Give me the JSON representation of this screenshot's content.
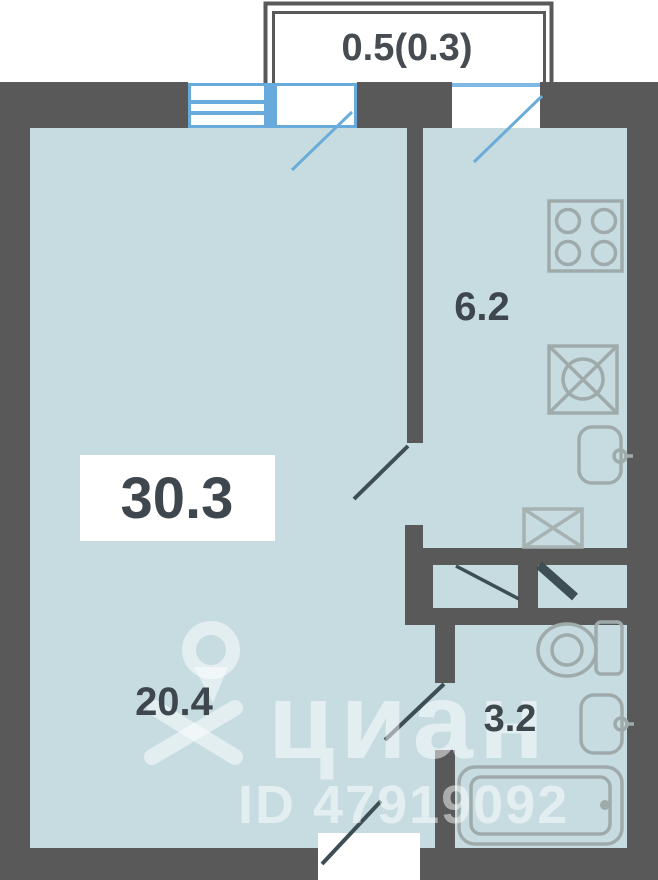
{
  "plan": {
    "balcony_label": "0.5(0.3)",
    "rooms": [
      {
        "id": "total-area",
        "label": "30.3"
      },
      {
        "id": "living-room",
        "label": "20.4"
      },
      {
        "id": "kitchen",
        "label": "6.2"
      },
      {
        "id": "bathroom",
        "label": "3.2"
      }
    ],
    "fixtures": [
      "stove",
      "kitchen-sink",
      "kitchen-washbasin",
      "wardrobe",
      "toilet",
      "washbasin",
      "bathtub"
    ],
    "colors": {
      "wall": "#595959",
      "floor": "#c6dce1",
      "window_blue": "#67aadb",
      "door_line": "#3e4e55",
      "fixture_stroke": "#9fabab",
      "label_text": "#3f474e"
    }
  },
  "watermark": {
    "brand": "циан",
    "listing_id": "ID 47919092"
  }
}
